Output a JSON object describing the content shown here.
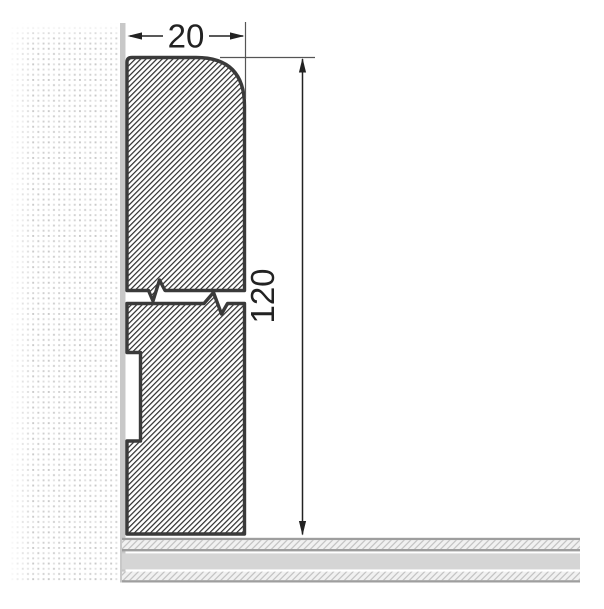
{
  "drawing": {
    "title": "skirting-board-cross-section",
    "width_dimension": {
      "label": "20"
    },
    "height_dimension": {
      "label": "120"
    },
    "parts": {
      "wall": "plastered wall (stippled)",
      "wall_surface": "wall surface strip",
      "profile_upper": "skirting profile upper section (hatched)",
      "profile_lower": "skirting profile lower section with rear groove (hatched)",
      "break": "break lines (shortened view)",
      "floor": "floor build-up: hatched screed, slab, hatched layer"
    },
    "colors": {
      "background": "#ffffff",
      "outline": "#3a3a3a",
      "hatch": "#2d2d2d",
      "wall_dot": "#cfcfcf",
      "wall_surface": "#c8c8c8",
      "floor_slab": "#d5d5d5",
      "floor_line": "#9e9e9e",
      "floor_hatch": "#bdbdbd",
      "dimension_line": "#222222",
      "dimension_text": "#222222"
    }
  }
}
